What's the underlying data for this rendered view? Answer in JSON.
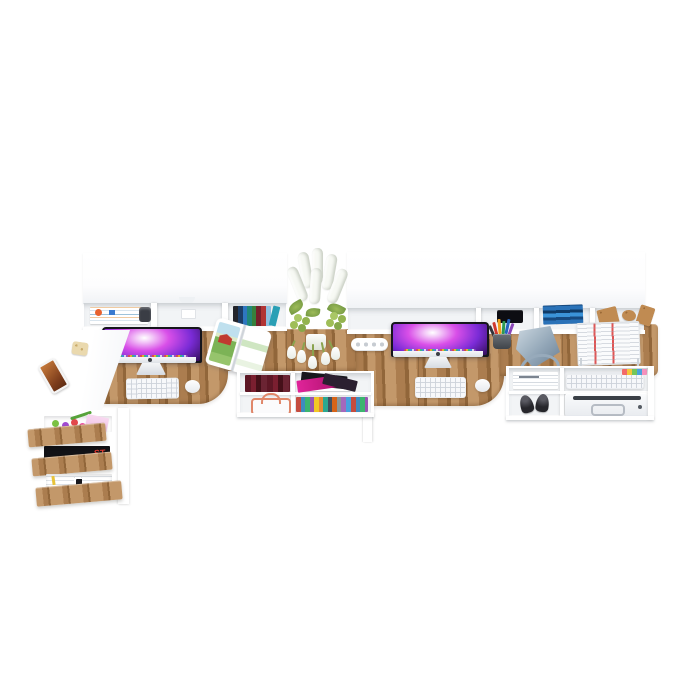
{
  "scene": {
    "label": "Furniture product render",
    "description": "3D product render, viewed from a high front angle on a plain white background, of a wall-mounted white and oak double-workstation desk system: two white hutches with open shelves above an oak desktop holding two iMac computers with purple galaxy wallpapers, white keyboards and mice, an open magazine with a red barn photo, a vase of white lupines and tulips, a white power strip, a gray cone desk lamp, a wire cup of colored pens and a wire basket of newspapers; below are white open shelf units with maroon books, colorful magazines, a copper wire basket, media cases, stacked documents, black shoes, a spare keyboard with sticky tabs and a white printer; at the left a white side table with a smartphone and a biscuit stands over a unit of three open oak-front drawers filled with toys, a pink notepad and magazines.",
    "background": "#ffffff"
  },
  "colors": {
    "background": "#ffffff",
    "wood": "#ab7d4f",
    "wood_dark": "#91663a",
    "wood_light": "#c3986a",
    "panel": "#ffffff",
    "panel_interior": "#f2f4f6",
    "panel_edge": "#e2e5e9",
    "screen_magenta": "#d94fe8",
    "screen_purple": "#7a2bd6",
    "screen_deep": "#1c0836",
    "lamp_gray": "#93a7b8",
    "copper": "#e0876a",
    "magenta": "#e0249a",
    "cork": "#c08b52",
    "barn_red": "#c03a30",
    "field_green": "#7cb356",
    "sky_blue": "#bfe0ee",
    "paper_stripe_red": "#e05454"
  },
  "objects": {
    "left_side_table": {
      "label": "white side table",
      "items": [
        "smartphone with warm-toned photo on screen",
        "beige biscuit"
      ]
    },
    "left_drawer_unit": {
      "label": "three open drawers with oak fronts",
      "drawers": [
        {
          "contents": "colorful toy beads, green squiggle toy, pink notepad"
        },
        {
          "contents": "black magazine with red lettering",
          "magazine_text": "ST"
        },
        {
          "contents": "white and gray magazines with small black logo"
        }
      ]
    },
    "left_hutch": {
      "label": "white wall cabinet with open shelf",
      "shelf_items": [
        "stack of striped magazines and papers",
        "dark knitted item",
        "small white box",
        "row of multicolored books",
        "leaning teal book"
      ]
    },
    "left_workstation": {
      "monitor": "iMac with purple galaxy wallpaper and dock",
      "keyboard": "white keyboard",
      "mouse": "white mouse",
      "magazine": "open magazine showing a red barn in a green field"
    },
    "centerpiece": {
      "vase": "vase of white lupine spikes and hanging white tulips with green leaves and buds",
      "power_strip": "white power strip with four sockets"
    },
    "mid_shelf_unit": {
      "label": "white open shelf below desktop",
      "items": [
        "row of maroon books",
        "pile of black and magenta magazines",
        "copper wire basket",
        "row of multicolored media cases"
      ],
      "leg": "white support leg"
    },
    "right_hutch": {
      "label": "white wall cabinet with open shelf",
      "shelf_items": [
        "black speaker box",
        "stack of blue books",
        "cork pieces"
      ]
    },
    "right_workstation": {
      "monitor": "iMac with purple galaxy wallpaper and dock",
      "keyboard": "white keyboard",
      "mouse": "white mouse",
      "pen_cup": "wire cup with colored pens",
      "lamp": "gray cone desk lamp with ring base",
      "wire_basket": "wire basket stacked with newspapers with red stripes"
    },
    "right_shelf_unit": {
      "label": "white open shelf unit below desktop",
      "items": [
        "stack of documents",
        "pair of black shoes",
        "spare white keyboard with papers",
        "colorful sticky tabs",
        "white printer"
      ]
    }
  }
}
